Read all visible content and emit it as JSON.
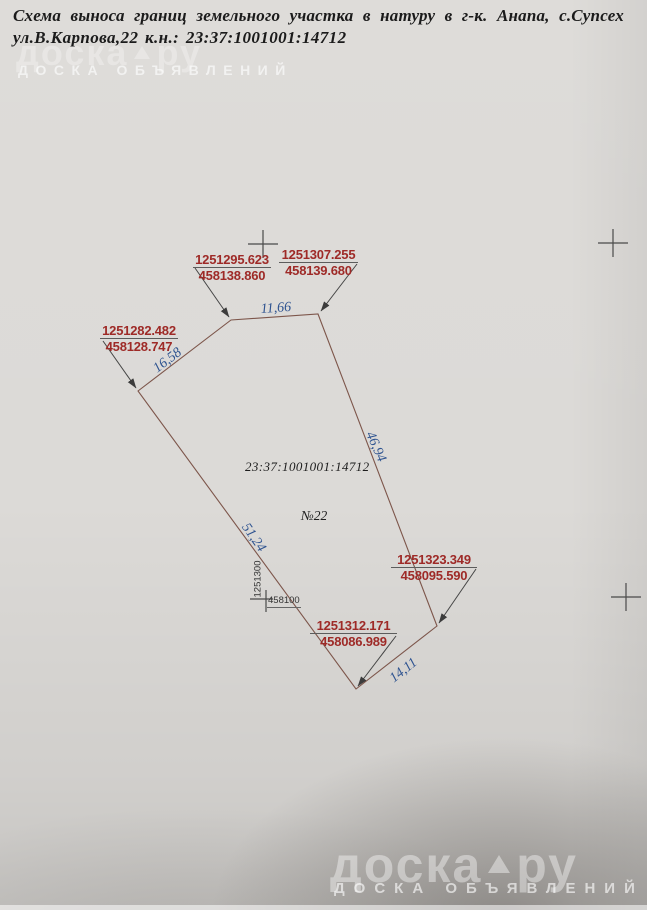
{
  "document": {
    "title_line1": "Схема выноса границ земельного участка в натуру в  г-к. Анапа, с.Супсех",
    "title_line2": "ул.В.Карпова,22 к.н.: 23:37:1001001:14712"
  },
  "watermark": {
    "brand": "доска",
    "brand_tld": "ру",
    "tagline": "ДОСКА ОБЪЯВЛЕНИЙ"
  },
  "diagram": {
    "cadastral_number": "23:37:1001001:14712",
    "plot_number": "№22",
    "grid_labels": {
      "x": "1251300",
      "y": "458100"
    },
    "points": [
      {
        "x": "1251295.623",
        "y": "458138.860"
      },
      {
        "x": "1251307.255",
        "y": "458139.680"
      },
      {
        "x": "1251282.482",
        "y": "458128.747"
      },
      {
        "x": "1251323.349",
        "y": "458095.590"
      },
      {
        "x": "1251312.171",
        "y": "458086.989"
      }
    ],
    "distances": [
      "11,66",
      "16,58",
      "46,94",
      "51,24",
      "14,11"
    ],
    "colors": {
      "coordinate_text": "#9e2a27",
      "distance_text": "#2e5390",
      "boundary_line": "#7d564b"
    }
  }
}
